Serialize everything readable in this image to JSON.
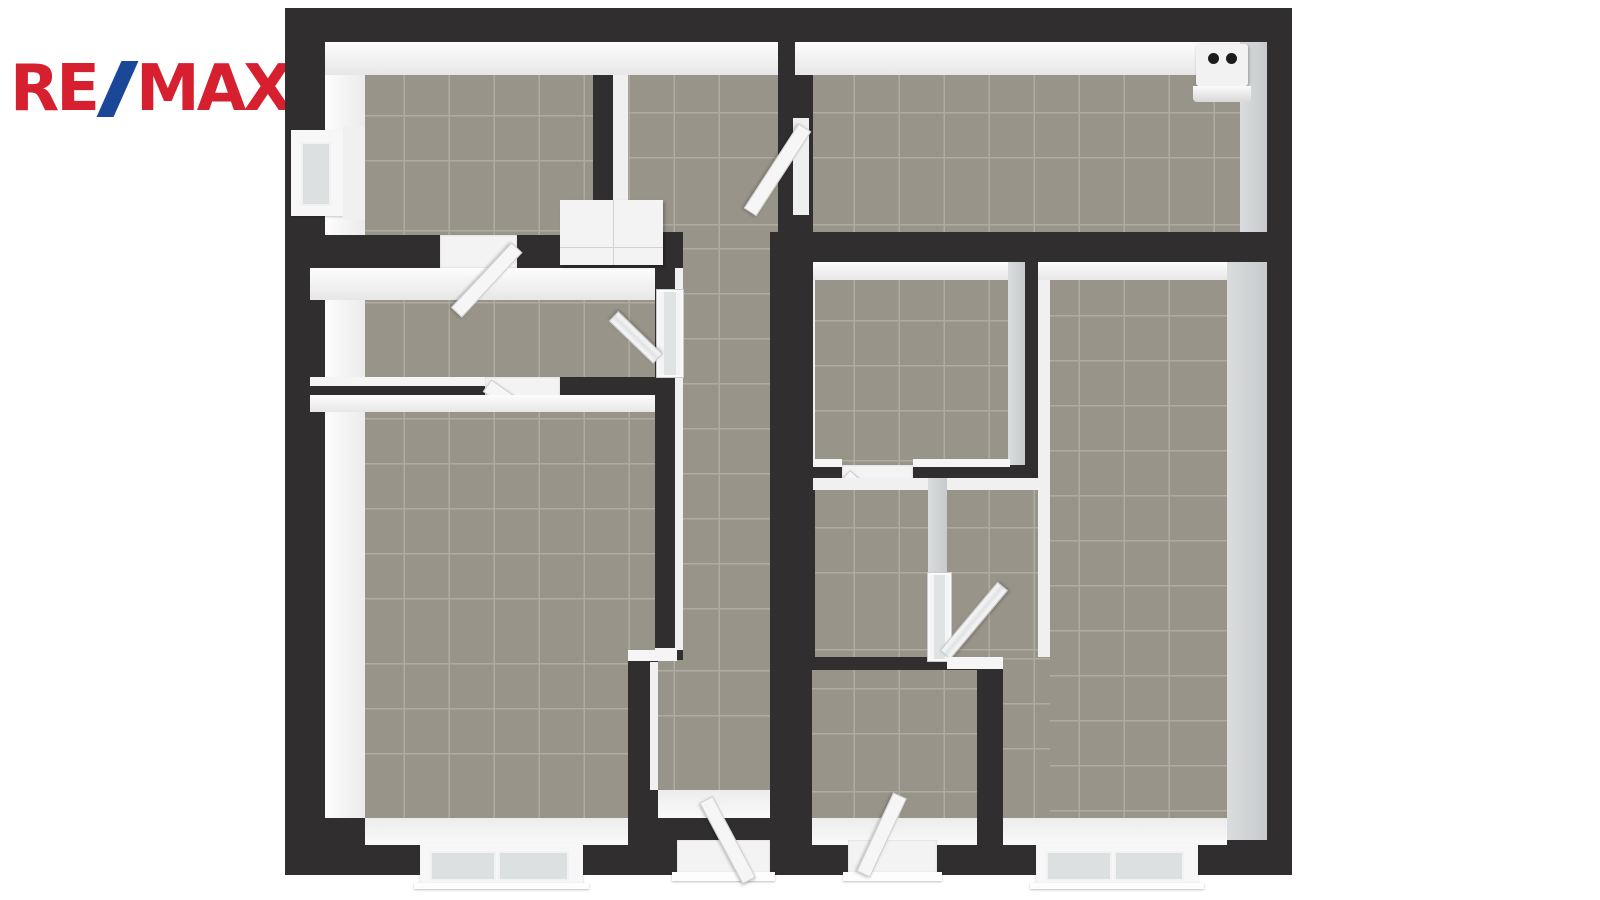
{
  "logo": {
    "re": "RE",
    "slash": "/",
    "max": "MAX"
  },
  "palette": {
    "background": "#FFFFFF",
    "brand_red": "#D6202F",
    "brand_blue": "#1A4798",
    "wall": "#302E2F",
    "floor": "#99948A",
    "grout": "#AFABA1",
    "face_light": "#F4F4F4",
    "face_shade": "#CDD0D2"
  },
  "floorplan": {
    "style": "3d-top-down-render",
    "rooms_visible": 8,
    "windows": [
      {
        "name": "window-left-wall"
      },
      {
        "name": "window-bottom-left"
      },
      {
        "name": "window-bottom-right"
      }
    ],
    "exterior_doors": [
      {
        "name": "door-bottom-corridor",
        "state": "open"
      },
      {
        "name": "door-bottom-right-room",
        "state": "open"
      }
    ],
    "interior_doors": [
      {
        "name": "door-topleft-to-anteroom",
        "state": "open"
      },
      {
        "name": "door-anteroom-to-bottomleft",
        "state": "open"
      },
      {
        "name": "door-glazed-anteroom-corridor",
        "state": "open"
      },
      {
        "name": "door-hall-to-topright",
        "state": "open"
      },
      {
        "name": "door-midright-to-wc",
        "state": "open"
      },
      {
        "name": "door-glazed-wc-passage",
        "state": "open"
      }
    ],
    "fixtures": [
      {
        "name": "water-heater",
        "knobs": 2
      },
      {
        "name": "built-in-cabinet"
      }
    ]
  }
}
